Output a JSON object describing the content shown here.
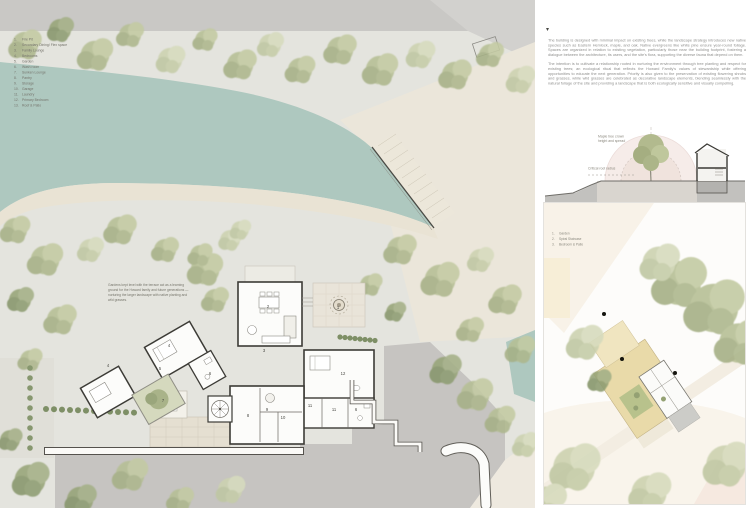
{
  "board": {
    "background": "#ffffff"
  },
  "colors": {
    "water": "#aec8bf",
    "foliage": "#b6bf95",
    "foliage_dark": "#93a178",
    "sand": "#e9e3d4",
    "plateau_gray": "#c6c4c1",
    "roof_tan": "#e9daa9",
    "crown_pink": "#e7c9c2",
    "body_text": "#8f8f8d"
  },
  "marker_glyph": "▾",
  "body_text": {
    "p1": "The building is designed with minimal impact on existing trees, while the landscape strategy introduces new native species such as Eastern Hemlock, maple, and oak. Native evergreens like white pine ensure year-round foliage. Spaces are organized in relation to existing vegetation, particularly those near the building footprint, fostering a dialogue between the architecture, its users, and the site's flora, supporting the diverse fauna that depend on them.",
    "p2": "The intention is to cultivate a relationship rooted in nurturing the environment through tree planting and respect for existing trees; an ecological ritual that reflects the Howard Family's values of stewardship while offering opportunities to educate the next generation. Priority is also given to the preservation of existing flowering shrubs and grasses, while wild grasses are celebrated as decorative landscape elements, blending seamlessly with the natural foliage of the site and providing a landscape that is both ecologically sensitive and visually compelling."
  },
  "plan": {
    "legend": {
      "items": [
        {
          "n": "1.",
          "t": "Fire Pit"
        },
        {
          "n": "2.",
          "t": "Secondary Dining/ Flex space"
        },
        {
          "n": "3.",
          "t": "Family Lounge"
        },
        {
          "n": "4.",
          "t": "Bedrooms"
        },
        {
          "n": "5.",
          "t": "Garden"
        },
        {
          "n": "6.",
          "t": "Wash room"
        },
        {
          "n": "7.",
          "t": "Sunken Lounge"
        },
        {
          "n": "8.",
          "t": "Pantry"
        },
        {
          "n": "9.",
          "t": "Storage"
        },
        {
          "n": "10.",
          "t": "Garage"
        },
        {
          "n": "11.",
          "t": "Laundry"
        },
        {
          "n": "12.",
          "t": "Primary Bedroom"
        },
        {
          "n": "13.",
          "t": "Roof & Patio"
        }
      ]
    },
    "annotation": "Gardens kept level with the terrace act as a learning ground for the Howard family and future generations — nurturing the larger landscape with native planting and wild grasses.",
    "room_labels": [
      "1",
      "2",
      "3",
      "4",
      "4",
      "5",
      "6",
      "6",
      "7",
      "8",
      "9",
      "10",
      "11",
      "11",
      "12"
    ]
  },
  "section": {
    "label_crown": "Maple tree crown\nheight and spread",
    "label_root": "Critical root radius"
  },
  "detail_plan": {
    "legend": {
      "items": [
        {
          "n": "1.",
          "t": "Garden"
        },
        {
          "n": "2.",
          "t": "Spiral Staircase"
        },
        {
          "n": "3.",
          "t": "Bedroom & Patio"
        }
      ]
    }
  }
}
